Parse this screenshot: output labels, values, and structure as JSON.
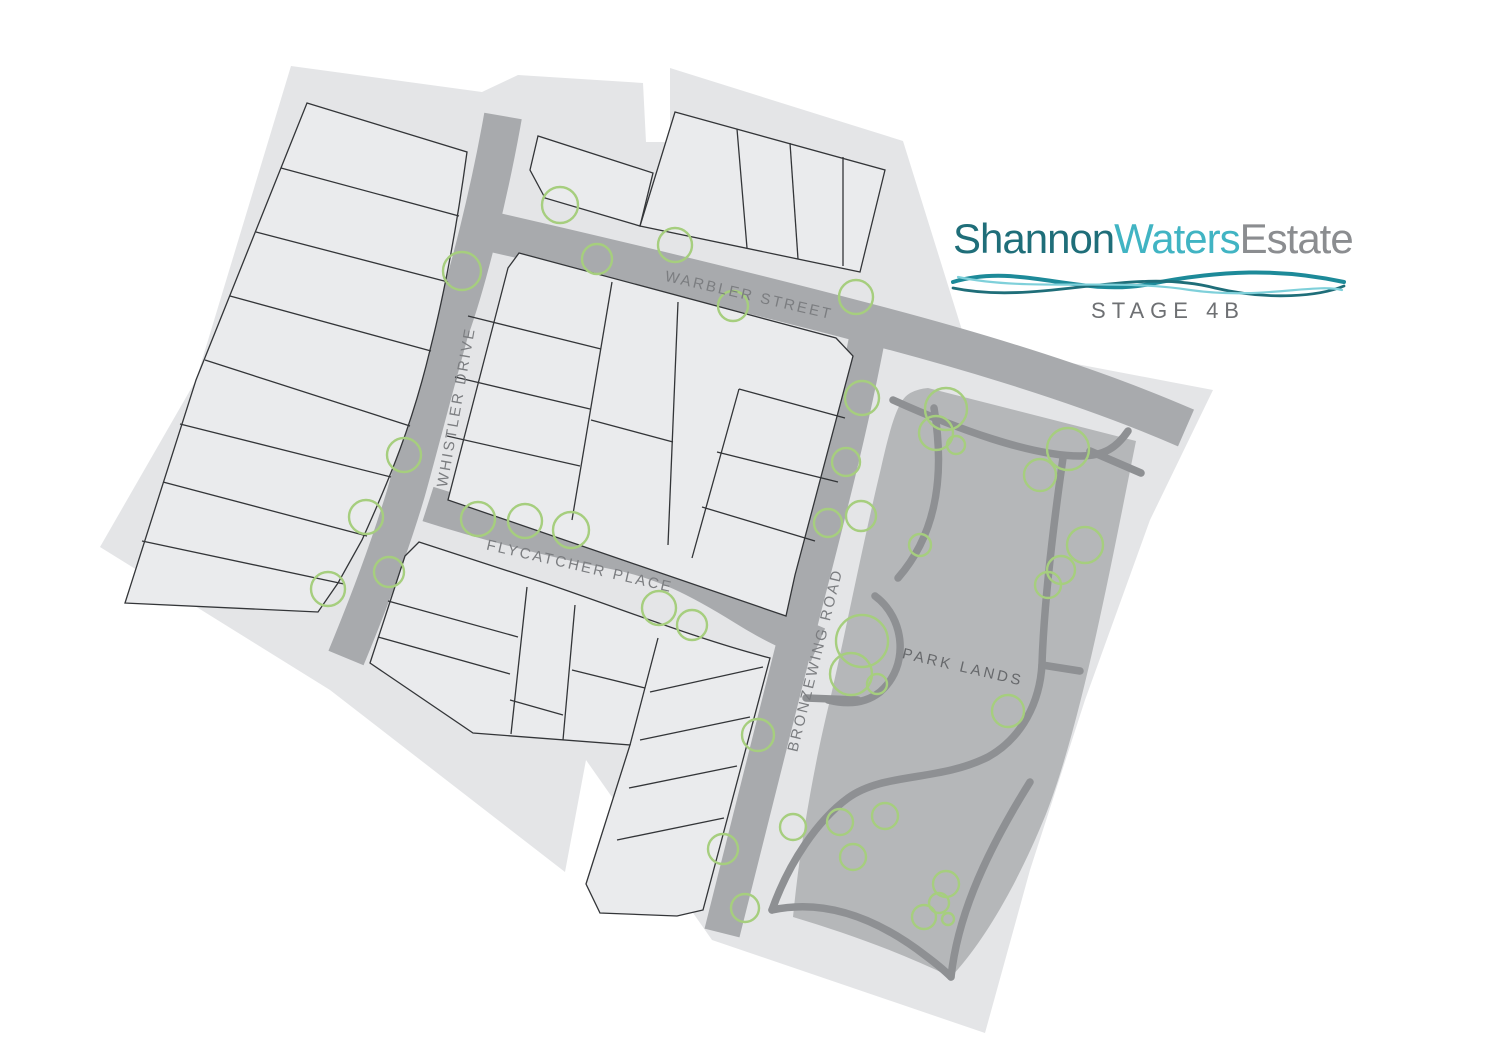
{
  "page": {
    "background": "#ffffff"
  },
  "logo": {
    "word_part_1": "Shannon",
    "word_part_2": "Waters",
    "word_part_3": "Estate",
    "stage_label": "STAGE 4B"
  },
  "map": {
    "street_labels": {
      "warbler": "WARBLER STREET",
      "whistler": "WHISTLER DRIVE",
      "flycatcher": "FLYCATCHER PLACE",
      "bronzewing": "BRONZEWING ROAD"
    },
    "park_label": "PARK LANDS",
    "trees": [
      [
        560,
        205,
        18
      ],
      [
        675,
        245,
        17
      ],
      [
        462,
        271,
        19
      ],
      [
        597,
        259,
        15
      ],
      [
        733,
        306,
        15
      ],
      [
        856,
        297,
        17
      ],
      [
        862,
        398,
        17
      ],
      [
        404,
        455,
        17
      ],
      [
        366,
        517,
        17
      ],
      [
        389,
        572,
        15
      ],
      [
        328,
        589,
        17
      ],
      [
        478,
        519,
        17
      ],
      [
        525,
        521,
        17
      ],
      [
        571,
        530,
        18
      ],
      [
        659,
        608,
        17
      ],
      [
        692,
        625,
        15
      ],
      [
        846,
        462,
        14
      ],
      [
        828,
        523,
        14
      ],
      [
        861,
        516,
        15
      ],
      [
        758,
        735,
        16
      ],
      [
        723,
        849,
        15
      ],
      [
        745,
        908,
        14
      ],
      [
        793,
        827,
        13
      ],
      [
        946,
        409,
        21
      ],
      [
        936,
        433,
        17
      ],
      [
        956,
        445,
        9
      ],
      [
        1068,
        449,
        21
      ],
      [
        1040,
        475,
        16
      ],
      [
        1085,
        545,
        18
      ],
      [
        1061,
        570,
        14
      ],
      [
        920,
        545,
        11
      ],
      [
        1048,
        585,
        13
      ],
      [
        862,
        641,
        26
      ],
      [
        851,
        674,
        21
      ],
      [
        877,
        684,
        10
      ],
      [
        1008,
        711,
        16
      ],
      [
        840,
        822,
        13
      ],
      [
        885,
        816,
        13
      ],
      [
        853,
        857,
        13
      ],
      [
        946,
        884,
        13
      ],
      [
        939,
        903,
        10
      ],
      [
        924,
        917,
        12
      ],
      [
        948,
        919,
        6
      ]
    ]
  },
  "theme": {
    "page_bg": "#ffffff",
    "backdrop": "#e4e5e7",
    "lot_fill": "#eaebed",
    "lot_stroke": "#333538",
    "road": "#a8aaad",
    "park": "#b5b7b9",
    "park_path": "#8e9093",
    "tree": "#a6ce7e",
    "street_label": "#7b7d80",
    "park_label": "#66686b",
    "stage": "#6e7073",
    "logo_dark": "#1f6e79",
    "logo_light": "#41b4c3",
    "logo_gray": "#8b8d90",
    "logo_mid": "#1d8a99",
    "logo_pale": "#7fd0da"
  }
}
